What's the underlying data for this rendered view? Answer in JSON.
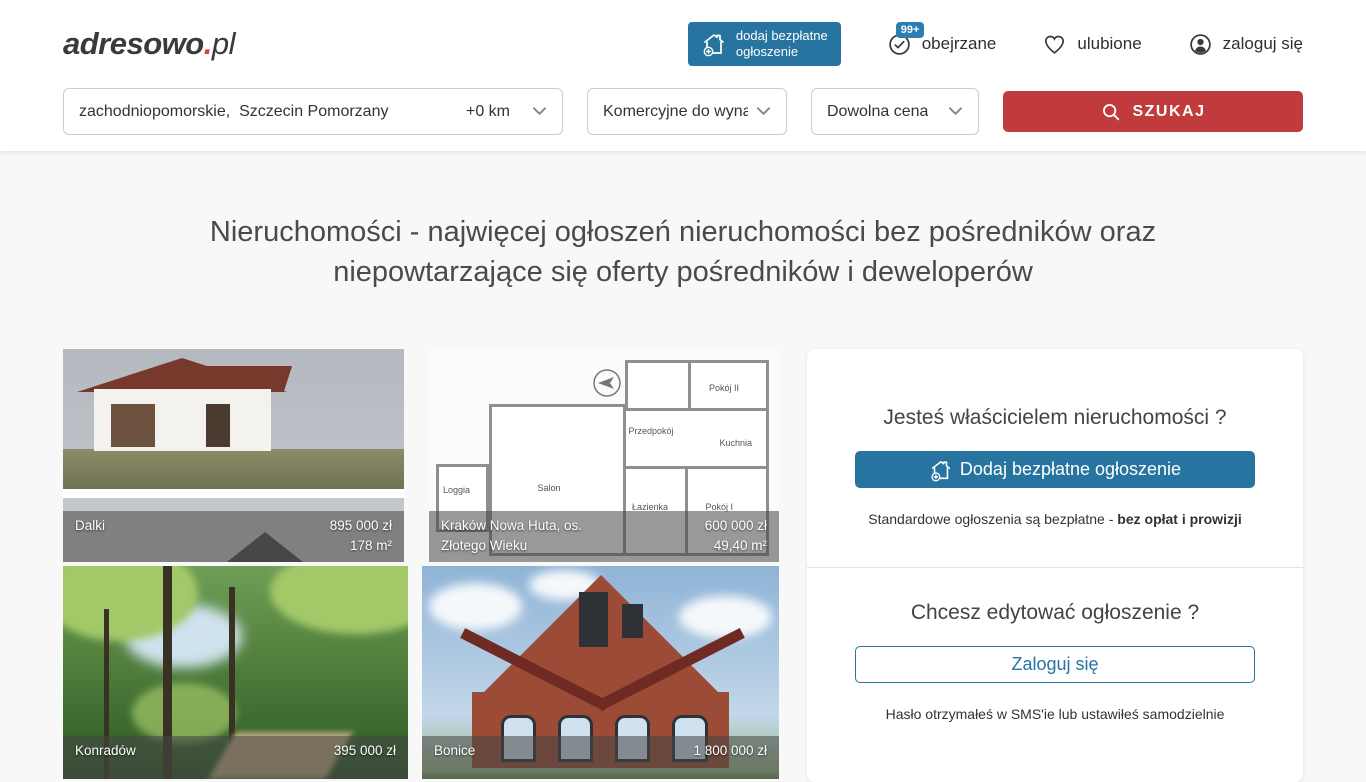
{
  "colors": {
    "primary_blue": "#26749f",
    "badge_blue": "#2d7cb2",
    "action_red": "#c23b3c",
    "logo_dot_red": "#e23b3b",
    "heading_gray": "#4a4a4a"
  },
  "logo": {
    "main": "adresowo",
    "dot": ".",
    "tld": "pl"
  },
  "header": {
    "add_button": {
      "label_line1": "dodaj bezpłatne",
      "label_line2": "ogłoszenie"
    },
    "viewed_badge": "99+",
    "viewed_label": "obejrzane",
    "favorites_label": "ulubione",
    "login_label": "zaloguj się"
  },
  "search": {
    "location_value": "zachodniopomorskie,  Szczecin Pomorzany",
    "radius_value": "+0 km",
    "category_value": "Komercyjne do wynaję",
    "price_value": "Dowolna cena",
    "submit_label": "SZUKAJ"
  },
  "hero_title": "Nieruchomości - najwięcej ogłoszeń nieruchomości bez pośredników oraz niepowtarzające się oferty pośredników i deweloperów",
  "listings": [
    {
      "name": "Dalki",
      "price": "895 000 zł",
      "area": "178 m²"
    },
    {
      "name": "Kraków Nowa Huta, os. Złotego Wieku",
      "price": "600 000 zł",
      "area": "49,40 m²"
    },
    {
      "name": "Konradów",
      "price": "395 000 zł",
      "area": ""
    },
    {
      "name": "Bonice",
      "price": "1 800 000 zł",
      "area": ""
    }
  ],
  "floorplan_rooms": {
    "room2": "Pokój II",
    "hall": "Przedpokój",
    "kitchen": "Kuchnia",
    "loggia": "Loggia",
    "salon": "Salon",
    "bath": "Łazienka",
    "room1": "Pokój I"
  },
  "sidebar": {
    "owner_title": "Jesteś właścicielem nieruchomości ?",
    "owner_button": "Dodaj bezpłatne ogłoszenie",
    "owner_note": "Standardowe ogłoszenia są bezpłatne - ",
    "owner_note_bold": "bez opłat i prowizji",
    "edit_title": "Chcesz edytować ogłoszenie ?",
    "edit_button": "Zaloguj się",
    "edit_note": "Hasło otrzymałeś w SMS'ie lub ustawiłeś samodzielnie"
  }
}
